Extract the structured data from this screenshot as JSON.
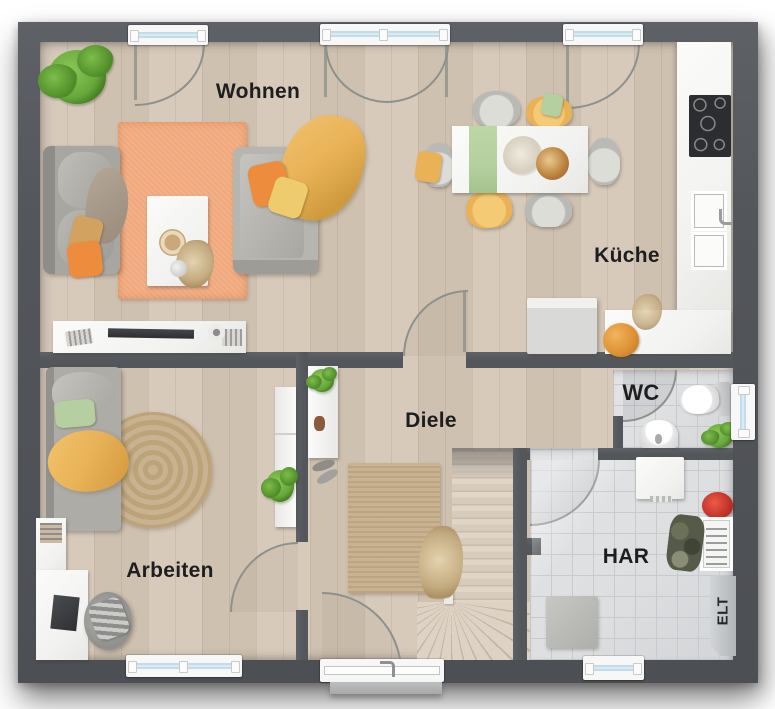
{
  "rooms": {
    "living": "Wohnen",
    "kitchen": "Küche",
    "hallway": "Diele",
    "office": "Arbeiten",
    "wc": "WC",
    "utility": "HAR",
    "electrical_cabinet": "ELT"
  },
  "colors": {
    "wall": "#53565b",
    "wall_light": "#5e6166",
    "floor_wood": "#d7cabb",
    "floor_wood_dark": "#cfc1b0",
    "floor_tile": "#dcdee0",
    "tile_line": "#c8cbce",
    "rug_orange": "#f0a87c",
    "rug_jute": "#c9b28f",
    "sofa_gray": "#a8a6a1",
    "accent_orange": "#ee8c3d",
    "accent_mustard": "#e9b257",
    "accent_sage": "#b5cfa0",
    "plant_green": "#67a83b",
    "white_furniture": "#f1f1ef",
    "arc_line": "#8e918b",
    "glass_blue": "#c2dcea",
    "label_text": "#1e1e20"
  }
}
